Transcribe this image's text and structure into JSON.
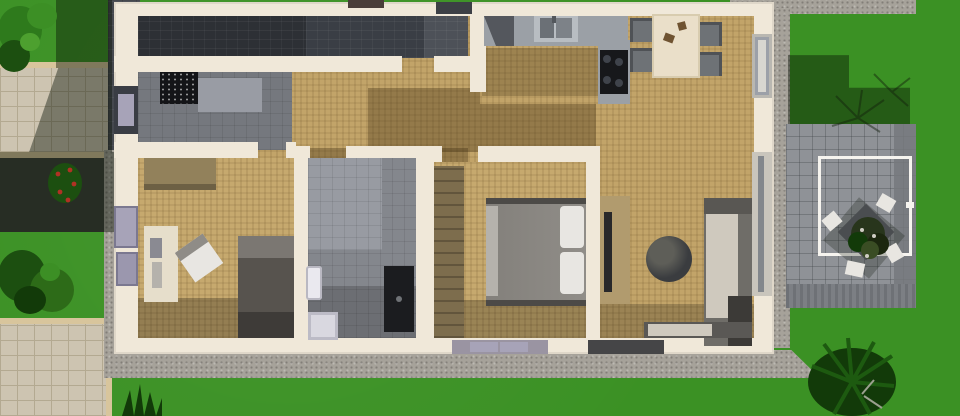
{
  "scene": {
    "title": "3D top-down floor plan render of a single-storey house with yard",
    "view": "orthographic top-down",
    "image_size": {
      "width": 960,
      "height": 416
    }
  },
  "palette": {
    "lawn": "#3B9124",
    "lawn_shadow": "#14430D",
    "gravel": "#A6A29A",
    "paver": "#CDC4B1",
    "paver_line": "#B3A991",
    "paver_edge": "#D8C59C",
    "drive_dark": "#45484E",
    "pavement_shadow": "#3F423C",
    "wall_cream": "#F0E8D9",
    "wall_shade": "#D9D0C0",
    "wood": "#C2A469",
    "wood2": "#C6A96E",
    "wood_shadow": "rgba(62,46,18,0.35)",
    "floor_dark": "#2D3035",
    "floor_dark2": "#3A3E45",
    "floor_dark3": "#4D5158",
    "tile_grey": "#75787E",
    "tile_light": "#999CA4",
    "mat_black": "#141518",
    "counter": "#9BA0A6",
    "counter_dark": "#54575D",
    "steel": "#B8BDC2",
    "basin": "#6B7076",
    "cooktop": "#17181B",
    "burner": "#3F434B",
    "table_cream": "#EADFC9",
    "chair_grey": "#6E7276",
    "chair_seat": "#4F5256",
    "wardrobe": "#92815B",
    "wardrobe_dark": "#7D6D4D",
    "desk_cream": "#E6DECB",
    "bed_dark": "#57534E",
    "bed_dark_head": "#7B7772",
    "bed_dark_foot": "#3E3B38",
    "duvet": "#908D88",
    "pillow": "#E8E6E2",
    "bed_frame": "#4C4A47",
    "bench": "#B5B2AC",
    "bath_tile": "#84878D",
    "bath_tile_light": "#989BA2",
    "fixture_white": "#EAE9EF",
    "tub": "#D9D8E0",
    "tub_inner": "#BCBBC6",
    "shower_black": "#1B1C1F",
    "tv_unit": "#B19B6E",
    "tv_black": "#28282A",
    "ottoman": "#3A3C3F",
    "sofa_frame": "#6F6D68",
    "sofa_cushion": "#CFC9BE",
    "sofa_dark": "#3C3A37",
    "sofa_arm": "#595753",
    "chaise": "#5A5855",
    "patio_tile": "#8F9297",
    "patio_border": "#75787D",
    "deck_a": "#6E7176",
    "deck_b": "#7C7F84",
    "pergola_white": "#F6F4EF",
    "out_table": "#4A4D50",
    "out_chair": "#E8E6E1",
    "window_lilac": "#A7A3B8",
    "window_lilac2": "#9B97AE",
    "window_dark": "#454547",
    "glass": "#83878C",
    "door_dark": "#3A3D44",
    "sill_grey": "#9A94A2",
    "bush_green": "#2E7A1C",
    "bush_light": "#3C8F25",
    "bush_dark": "#1C4F10",
    "bush_darker": "#123A09",
    "berry_red": "#B03224",
    "plant_dark": "#28351C"
  },
  "house": {
    "rooms": [
      {
        "name": "garage-utility",
        "floor": "dark tile"
      },
      {
        "name": "entry-hall",
        "floor": "grey tile",
        "items": [
          "black doormat",
          "concrete pad"
        ]
      },
      {
        "name": "corridor",
        "floor": "light wood with cast shadows"
      },
      {
        "name": "kitchen",
        "floor": "light wood",
        "items": [
          "L-counter",
          "sink",
          "cooktop with 4 burners"
        ]
      },
      {
        "name": "dining-area",
        "items": [
          "cream table",
          "4 grey chairs"
        ]
      },
      {
        "name": "living-area",
        "items": [
          "tv-unit",
          "round dark ottoman",
          "L-shaped sofa"
        ]
      },
      {
        "name": "bedroom-left",
        "items": [
          "wardrobe",
          "desk",
          "white office chair",
          "dark single bed"
        ]
      },
      {
        "name": "bathroom",
        "items": [
          "sink",
          "bathtub",
          "black shower cabin"
        ]
      },
      {
        "name": "master-bedroom",
        "items": [
          "tall wardrobe",
          "double bed with grey duvet and two white pillows",
          "foot bench"
        ]
      }
    ],
    "openings": [
      {
        "name": "front-door-left-wall"
      },
      {
        "name": "left-wall-window-1"
      },
      {
        "name": "left-wall-window-2"
      },
      {
        "name": "top-wall-window"
      },
      {
        "name": "bottom-window-lilac"
      },
      {
        "name": "bottom-window-dark"
      },
      {
        "name": "right-sliding-glass-door"
      },
      {
        "name": "right-wall-window"
      }
    ]
  },
  "yard": {
    "features": [
      {
        "name": "left-lawn"
      },
      {
        "name": "paver-walkway-upper"
      },
      {
        "name": "paver-walkway-lower"
      },
      {
        "name": "dark-driveway-strip"
      },
      {
        "name": "gravel-apron"
      },
      {
        "name": "gravel-path-top"
      },
      {
        "name": "patio",
        "items": [
          "white pergola frame",
          "outdoor table",
          "potted plant",
          "4 white chairs",
          "deck-board border"
        ]
      },
      {
        "name": "bush-top-left"
      },
      {
        "name": "red-berry-bush"
      },
      {
        "name": "bushes-bottom-left"
      },
      {
        "name": "grass-tuft-bottom-center"
      },
      {
        "name": "bush-bottom-right"
      },
      {
        "name": "house-shadow-left"
      },
      {
        "name": "house-shadow-right"
      }
    ]
  }
}
